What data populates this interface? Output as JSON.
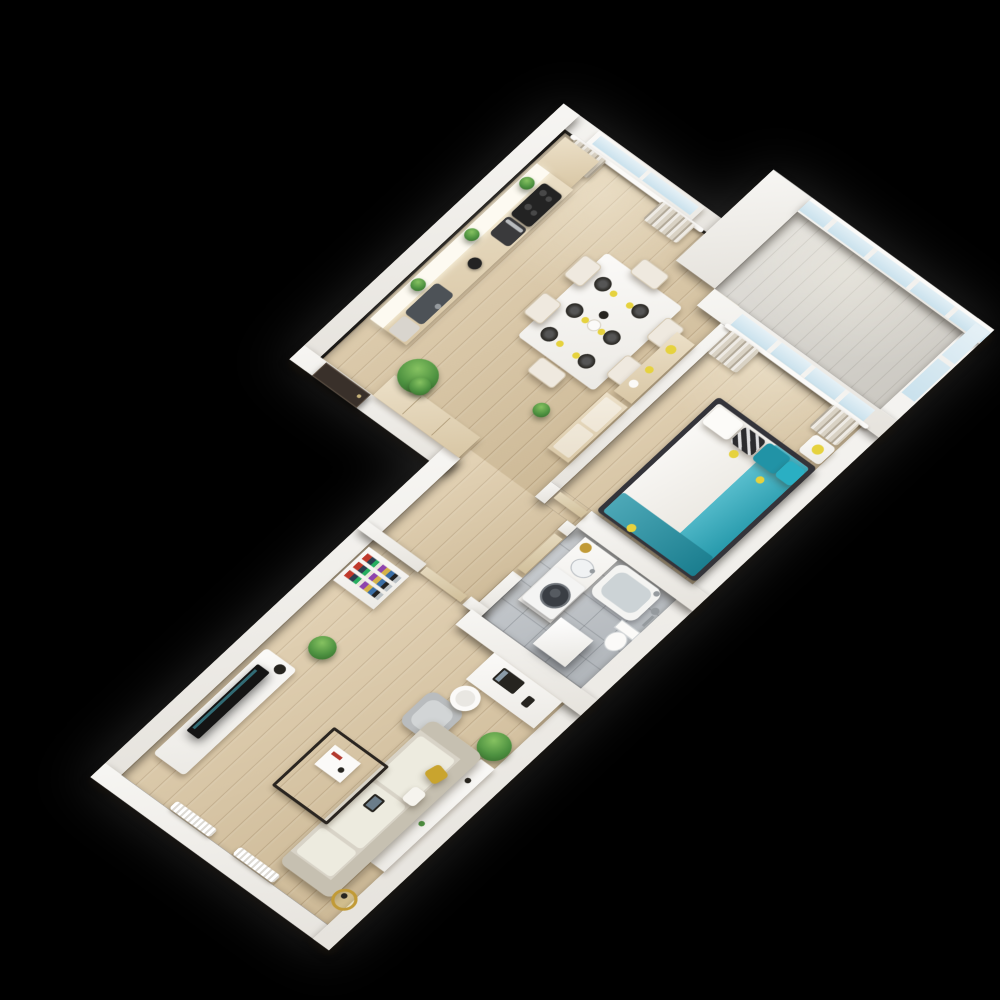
{
  "scene": {
    "background": "#000000"
  },
  "palette": {
    "wall": "#f2f0ed",
    "floor_wood": "#dcc7a2",
    "floor_bath": "#b9bec3",
    "floor_balcony": "#d6d3cc",
    "glass": "#c7e0ec",
    "curtain": "#d9d2c4",
    "wood": "#e6d6b6",
    "wood_door": "#ddcda9",
    "white_furniture": "#f9f8f6",
    "shelf_light": "#fdfaf1",
    "entry_door": "#39302a",
    "appliance_dark": "#232323",
    "oven": "#3a3a3c",
    "sink_metal": "#4d5257",
    "dishwasher": "#d9d5ce",
    "sofa": "#d8d3c7",
    "sofa_shade": "#c6c0b1",
    "cushion": "#edebdf",
    "seat_grey": "#b9bcbe",
    "seat_grey_light": "#d2d5d6",
    "teal": "#2aafc3",
    "teal_dark": "#2193a6",
    "yellow": "#e6d23e",
    "mustard": "#c9a42e",
    "gold": "#c19a36",
    "green": "#4d9140",
    "green_dark": "#35702c",
    "dark": "#26241f",
    "metal": "#959a9e",
    "tub_inner": "#ccd3d6",
    "mattress": "#f7f5f0",
    "duvet": "#f2efe9",
    "pillow_pattern": "#2c2c2e",
    "tv_black": "#141414",
    "bed_frame": "#34343a"
  },
  "apartment": {
    "rooms": [
      {
        "id": "kitchen-dining",
        "furniture": [
          "kitchen-counter",
          "corner-cabinet",
          "cooktop",
          "oven",
          "kettle",
          "sink",
          "dishwasher",
          "shelf-plant",
          "shelf-plant",
          "shelf-plant",
          "dining-table",
          "chair",
          "chair",
          "chair",
          "chair",
          "chair",
          "chair",
          "plate-x6",
          "napkin-x6",
          "sideboard",
          "wardrobe",
          "plant-large",
          "plant-small",
          "hall-closet"
        ]
      },
      {
        "id": "entry-hall",
        "furniture": [
          "entry-door",
          "closet"
        ]
      },
      {
        "id": "balcony",
        "furniture": [
          "glazing"
        ]
      },
      {
        "id": "bedroom",
        "furniture": [
          "double-bed",
          "teal-blanket",
          "pillows",
          "nightstand",
          "lamp",
          "curtains",
          "window"
        ]
      },
      {
        "id": "bathroom",
        "furniture": [
          "vanity",
          "sink",
          "washing-machine",
          "bathtub",
          "toilet",
          "shower",
          "storage-cube",
          "basket"
        ]
      },
      {
        "id": "living-room",
        "furniture": [
          "sofa",
          "console-table",
          "coffee-table",
          "armchair",
          "tv-stand",
          "tv",
          "speaker",
          "bookshelf",
          "aloe-plant",
          "palm-plant",
          "floor-lamp",
          "desk",
          "desk-chair",
          "laptop",
          "radiator",
          "radiator",
          "interior-door"
        ]
      }
    ]
  }
}
